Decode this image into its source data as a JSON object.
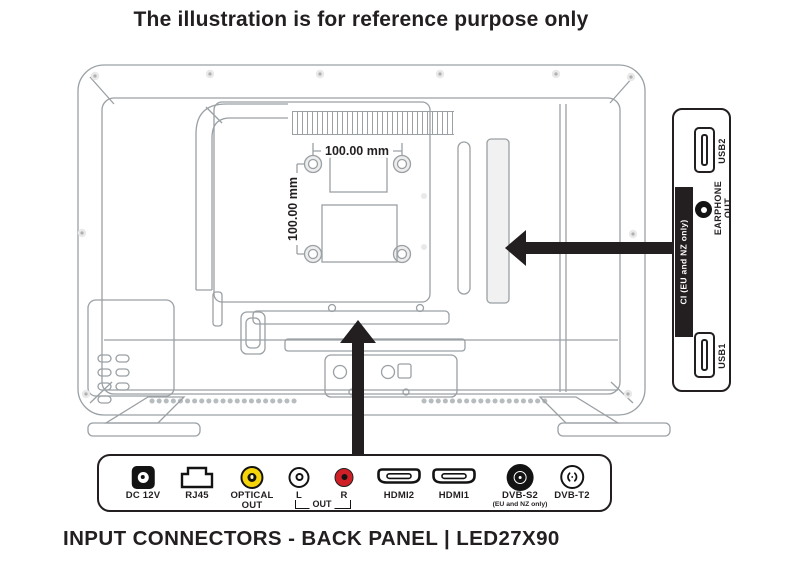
{
  "title": "The illustration is for reference purpose only",
  "caption": "INPUT CONNECTORS - BACK PANEL | LED27X90",
  "vesa": {
    "width_label": "100.00 mm",
    "height_label": "100.00 mm"
  },
  "side_panel": {
    "ports": [
      {
        "id": "usb2",
        "icon": "usb-port-icon",
        "label": "USB2"
      },
      {
        "id": "earphone",
        "icon": "earphone-jack-icon",
        "label_line1": "EARPHONE",
        "label_line2": "OUT"
      },
      {
        "id": "ci",
        "icon": "ci-slot",
        "label": "CI (EU and NZ only)"
      },
      {
        "id": "usb1",
        "icon": "usb-port-icon",
        "label": "USB1"
      }
    ]
  },
  "bottom_panel": {
    "connectors": [
      {
        "id": "dc12v",
        "icon": "dc-jack-icon",
        "label": "DC 12V"
      },
      {
        "id": "rj45",
        "icon": "rj45-port-icon",
        "label": "RJ45"
      },
      {
        "id": "optical",
        "icon": "optical-jack-icon",
        "label": "OPTICAL",
        "label2": "OUT"
      },
      {
        "id": "av-l",
        "icon": "rca-jack-white-icon",
        "label": "L"
      },
      {
        "id": "av-out",
        "icon": "none",
        "label": "OUT"
      },
      {
        "id": "av-r",
        "icon": "rca-jack-red-icon",
        "label": "R"
      },
      {
        "id": "hdmi2",
        "icon": "hdmi-port-icon",
        "label": "HDMI2"
      },
      {
        "id": "hdmi1",
        "icon": "hdmi-port-icon",
        "label": "HDMI1"
      },
      {
        "id": "dvbs2",
        "icon": "coax-satellite-icon",
        "label": "DVB-S2",
        "sublabel": "(EU and NZ only)"
      },
      {
        "id": "dvbt2",
        "icon": "coax-antenna-icon",
        "label": "DVB-T2"
      }
    ]
  },
  "colors": {
    "ink": "#231F20",
    "line_gray": "#9AA0A4",
    "optical_yellow": "#F5D409",
    "rca_red": "#CF2027"
  }
}
